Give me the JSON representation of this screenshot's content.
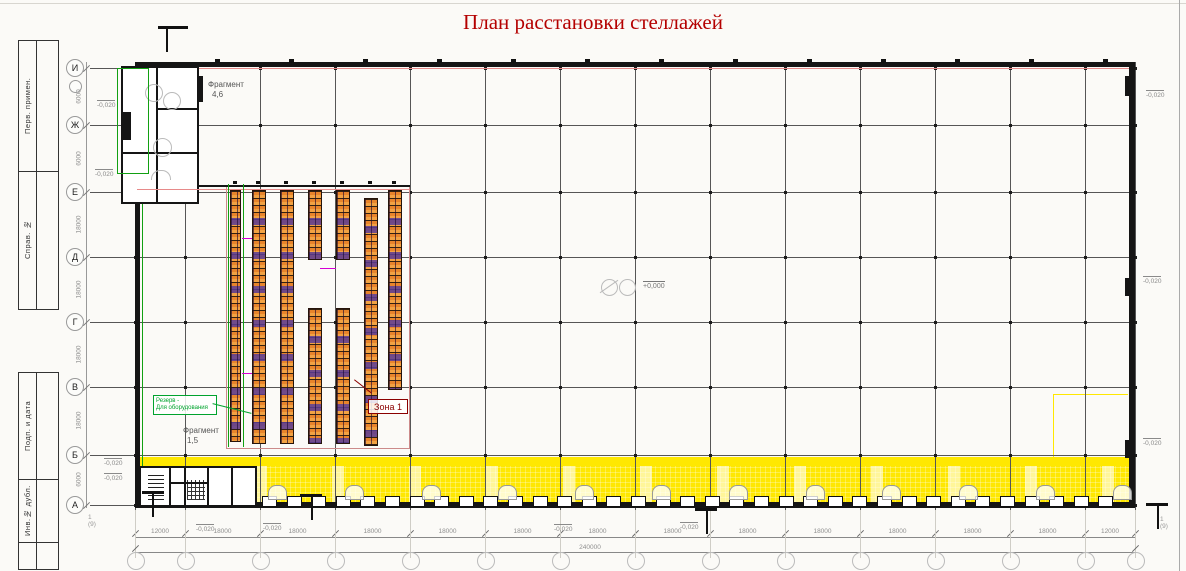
{
  "title": "План расстановки стеллажей",
  "frame": {
    "strip_top": [
      "Перв. примен.",
      "Справ. №"
    ],
    "strip_bottom": [
      "Подп. и дата",
      "Инв.№ дубл."
    ]
  },
  "grid": {
    "row_labels": [
      "И",
      "Ж",
      "Е",
      "Д",
      "Г",
      "В",
      "Б",
      "А"
    ]
  },
  "dimensions": {
    "bottom_bays": [
      "12000",
      "18000",
      "18000",
      "18000",
      "18000",
      "18000",
      "18000",
      "18000",
      "18000",
      "18000",
      "18000",
      "18000",
      "18000",
      "12000"
    ],
    "bottom_total": "240000",
    "left_bays": [
      "6000",
      "6000",
      "18000",
      "18000",
      "18000",
      "18000",
      "6000"
    ]
  },
  "labels": {
    "zone1": "Зона 1",
    "reserve_line1": "Резерв -",
    "reserve_line2": "Для оборудования",
    "fragment_top": "Фрагмент",
    "fragment_top_num": "4,6",
    "fragment_bottom": "Фрагмент",
    "fragment_bottom_num": "1,5",
    "elevation_zero": "+0,000",
    "elevation_neg": "-0,020",
    "section_ref": "1 (9)"
  },
  "colors": {
    "title": "#b40000",
    "zone_outline": "#8b0000",
    "rack_orange": "#e8842b",
    "reserve_green": "#00a32e",
    "dock_yellow": "#ffe800"
  }
}
